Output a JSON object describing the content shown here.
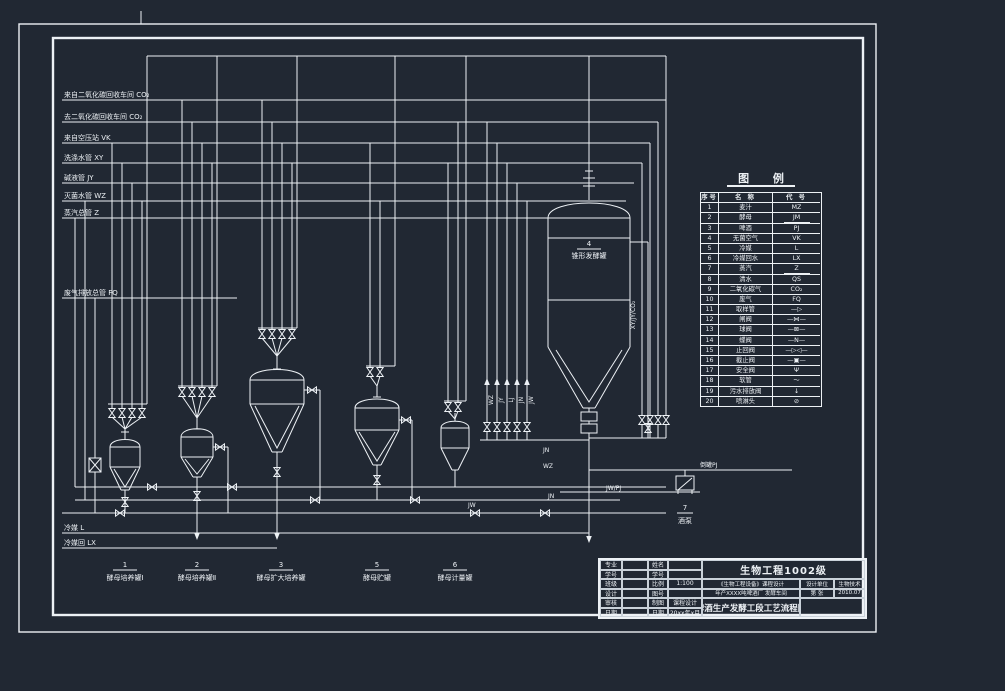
{
  "colors": {
    "bg": "#212833",
    "line": "#edf1f5"
  },
  "supply": [
    "来自二氧化碳回收车间 CO₂",
    "去二氧化碳回收车间 CO₂",
    "来自空压站 VK",
    "洗涤水管 XY",
    "碱液管 JY",
    "灭菌水管 WZ",
    "蒸汽总管 Z"
  ],
  "labels": {
    "offgas": "废气排放总管 FQ",
    "coolant_supply": "冷媒 L",
    "coolant_return": "冷媒回 LX",
    "beer_transfer": "倒罐PJ",
    "jw_pj": "JW/PJ",
    "jn_a": "JN",
    "wz_a": "WZ",
    "jw_a": "JW",
    "jn_b": "JN",
    "riser_bundle": "XY/JY/CO₂"
  },
  "feed_tags": [
    "WZ",
    "JY",
    "LJ",
    "JN",
    "JW"
  ],
  "equipment": [
    {
      "no": "1",
      "name": "酵母培养罐Ⅰ"
    },
    {
      "no": "2",
      "name": "酵母培养罐Ⅱ"
    },
    {
      "no": "3",
      "name": "酵母扩大培养罐"
    },
    {
      "no": "4",
      "name": "锥形发酵罐"
    },
    {
      "no": "5",
      "name": "酵母贮罐"
    },
    {
      "no": "6",
      "name": "酵母计量罐"
    },
    {
      "no": "7",
      "name": "酒泵"
    }
  ],
  "legend": {
    "title": "图 例",
    "headers": [
      "序号",
      "名 称",
      "代 号"
    ],
    "rows": [
      {
        "no": "1",
        "name": "麦汁",
        "code": "MZ",
        "cls": "cu"
      },
      {
        "no": "2",
        "name": "酵母",
        "code": "JM",
        "cls": "cu"
      },
      {
        "no": "3",
        "name": "啤酒",
        "code": "PJ",
        "cls": "cu"
      },
      {
        "no": "4",
        "name": "无菌空气",
        "code": "VK",
        "cls": "cu"
      },
      {
        "no": "5",
        "name": "冷媒",
        "code": "L",
        "cls": "cu"
      },
      {
        "no": "6",
        "name": "冷媒回水",
        "code": "LX",
        "cls": "cu"
      },
      {
        "no": "7",
        "name": "蒸汽",
        "code": "Z",
        "cls": "cu"
      },
      {
        "no": "8",
        "name": "清水",
        "code": "QS",
        "cls": "cu"
      },
      {
        "no": "9",
        "name": "二氧化碳气",
        "code": "CO₂",
        "cls": "cu"
      },
      {
        "no": "10",
        "name": "废气",
        "code": "FQ",
        "cls": "cu"
      },
      {
        "no": "11",
        "name": "取样管",
        "code": "—▷",
        "cls": "cs"
      },
      {
        "no": "12",
        "name": "闸阀",
        "code": "—⋈—",
        "cls": "cs"
      },
      {
        "no": "13",
        "name": "球阀",
        "code": "—⊠—",
        "cls": "cs"
      },
      {
        "no": "14",
        "name": "蝶阀",
        "code": "—Ν—",
        "cls": "cs"
      },
      {
        "no": "15",
        "name": "止回阀",
        "code": "—▷◁—",
        "cls": "cs"
      },
      {
        "no": "16",
        "name": "截止阀",
        "code": "—▣—",
        "cls": "cs"
      },
      {
        "no": "17",
        "name": "安全阀",
        "code": "Ψ",
        "cls": "cs"
      },
      {
        "no": "18",
        "name": "软管",
        "code": "～",
        "cls": "cs"
      },
      {
        "no": "19",
        "name": "污水排放阀",
        "code": "↓",
        "cls": "cs"
      },
      {
        "no": "20",
        "name": "喷淋头",
        "code": "⊘",
        "cls": "cs"
      }
    ]
  },
  "titleblock": {
    "class_title": "生物工程1002级",
    "course": "《生物工程设备》课程设计",
    "subtitle": "年产XXXX吨啤酒厂 发酵车间",
    "drawing_title": "啤酒生产发酵工段工艺流程图",
    "org_label": "设计单位",
    "org": "生物技术",
    "sheet": "第  张",
    "date": "2010.07",
    "fieldsA": [
      {
        "l": "专业",
        "v": ""
      },
      {
        "l": "学号",
        "v": ""
      },
      {
        "l": "班级",
        "v": ""
      },
      {
        "l": "设计",
        "v": ""
      },
      {
        "l": "审核",
        "v": ""
      },
      {
        "l": "日期",
        "v": ""
      }
    ],
    "fieldsB": [
      {
        "l": "姓名",
        "v": ""
      },
      {
        "l": "学号",
        "v": ""
      },
      {
        "l": "比例",
        "v": "1:100"
      },
      {
        "l": "图号",
        "v": ""
      },
      {
        "l": "制图",
        "v": "课程设计"
      },
      {
        "l": "日期",
        "v": "20xx年x月"
      }
    ]
  }
}
